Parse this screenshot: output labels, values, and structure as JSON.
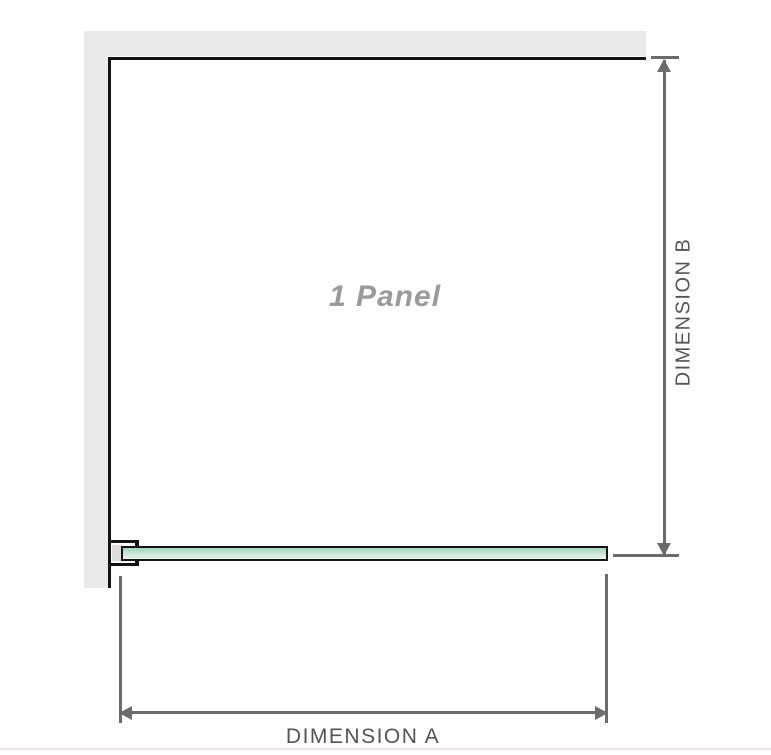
{
  "diagram": {
    "panel_label": "1 Panel",
    "dimension_a": {
      "label": "DIMENSION A",
      "orientation": "horizontal",
      "measures": "panel width"
    },
    "dimension_b": {
      "label": "DIMENSION B",
      "orientation": "vertical",
      "measures": "panel height"
    },
    "colors": {
      "wall": "#e9e9e9",
      "outline": "#141414",
      "dimension": "#6b6b6b",
      "label_text": "#545454",
      "panel_label": "#9a9a9a",
      "glass_top": "#a2d4b6",
      "glass_mid": "#cfe8d9",
      "glass_bottom": "#e9f5ed",
      "bracket_shadow": "#dcdcdc"
    }
  }
}
